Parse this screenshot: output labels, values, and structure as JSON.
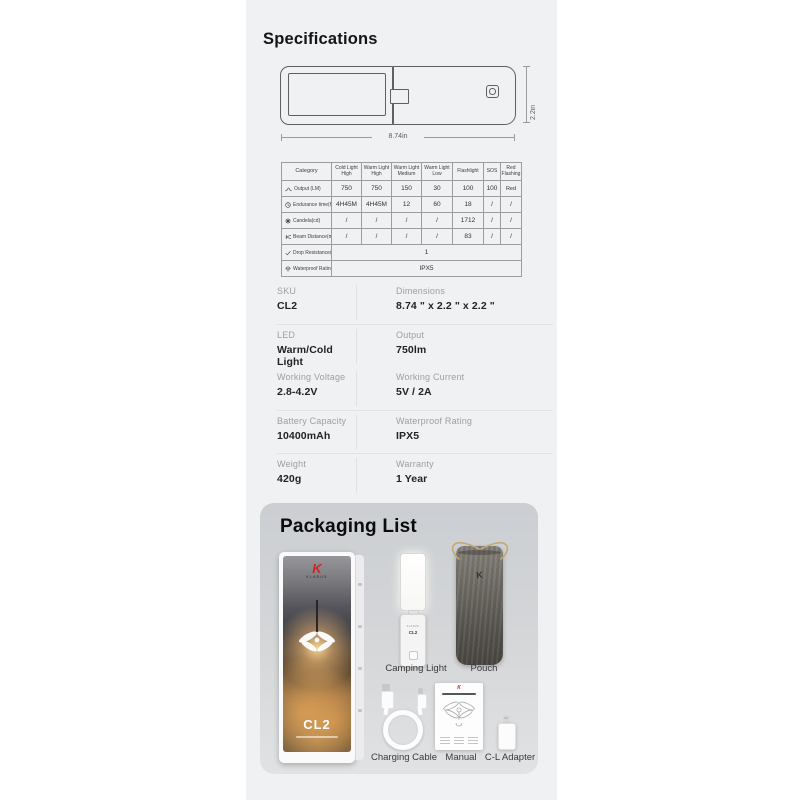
{
  "specifications": {
    "title": "Specifications",
    "diagram": {
      "length_label": "8.74in",
      "height_label": "2.2in"
    },
    "table": {
      "columns": [
        "Category",
        "Cold Light High",
        "Warm Light High",
        "Warm Light Medium",
        "Warm Light Low",
        "Flashlight",
        "SOS",
        "Red Flashing"
      ],
      "rows": [
        {
          "icon": "output-curve-icon",
          "label": "Output (LM)",
          "values": [
            "750",
            "750",
            "150",
            "30",
            "100",
            "100",
            "Red"
          ]
        },
        {
          "icon": "clock-icon",
          "label": "Endurance time(H)",
          "values": [
            "4H45M",
            "4H45M",
            "12",
            "60",
            "18",
            "/",
            "/"
          ]
        },
        {
          "icon": "sun-icon",
          "label": "Candela(cd)",
          "values": [
            "/",
            "/",
            "/",
            "/",
            "1712",
            "/",
            "/"
          ]
        },
        {
          "icon": "beam-icon",
          "label": "Beam Distance(m)",
          "values": [
            "/",
            "/",
            "/",
            "/",
            "83",
            "/",
            "/"
          ]
        },
        {
          "icon": "check-icon",
          "label": "Drop Resistance(m)",
          "span_value": "1"
        },
        {
          "icon": "umbrella-icon",
          "label": "Waterproof Rating",
          "span_value": "IPX5"
        }
      ]
    },
    "details": {
      "rows": [
        {
          "left": {
            "label": "SKU",
            "value": "CL2"
          },
          "right": {
            "label": "Dimensions",
            "value": "8.74 \" x 2.2 \" x 2.2 \""
          }
        },
        {
          "left": {
            "label": "LED",
            "value": "Warm/Cold Light"
          },
          "right": {
            "label": "Output",
            "value": "750lm"
          }
        },
        {
          "left": {
            "label": "Working Voltage",
            "value": "2.8-4.2V"
          },
          "right": {
            "label": "Working Current",
            "value": "5V / 2A"
          }
        },
        {
          "left": {
            "label": "Battery Capacity",
            "value": "10400mAh"
          },
          "right": {
            "label": "Waterproof Rating",
            "value": "IPX5"
          }
        },
        {
          "left": {
            "label": "Weight",
            "value": "420g"
          },
          "right": {
            "label": "Warranty",
            "value": "1 Year"
          }
        }
      ]
    }
  },
  "packaging": {
    "title": "Packaging List",
    "box": {
      "brand_initial": "K",
      "brand": "KLARUS",
      "model": "CL2"
    },
    "device": {
      "brand": "KLARUS",
      "model": "CL2"
    },
    "pouch_mark": "K",
    "manual_mark": "K",
    "items": [
      {
        "label": "Camping Light"
      },
      {
        "label": "Pouch"
      },
      {
        "label": "Charging Cable"
      },
      {
        "label": "Manual"
      },
      {
        "label": "C-L Adapter"
      }
    ]
  },
  "colors": {
    "page_bg": "#ffffff",
    "column_bg": "#f0f1f2",
    "accent_red": "#cf2421",
    "card_top": "#cbced2",
    "card_bottom": "#e1e2e4"
  }
}
